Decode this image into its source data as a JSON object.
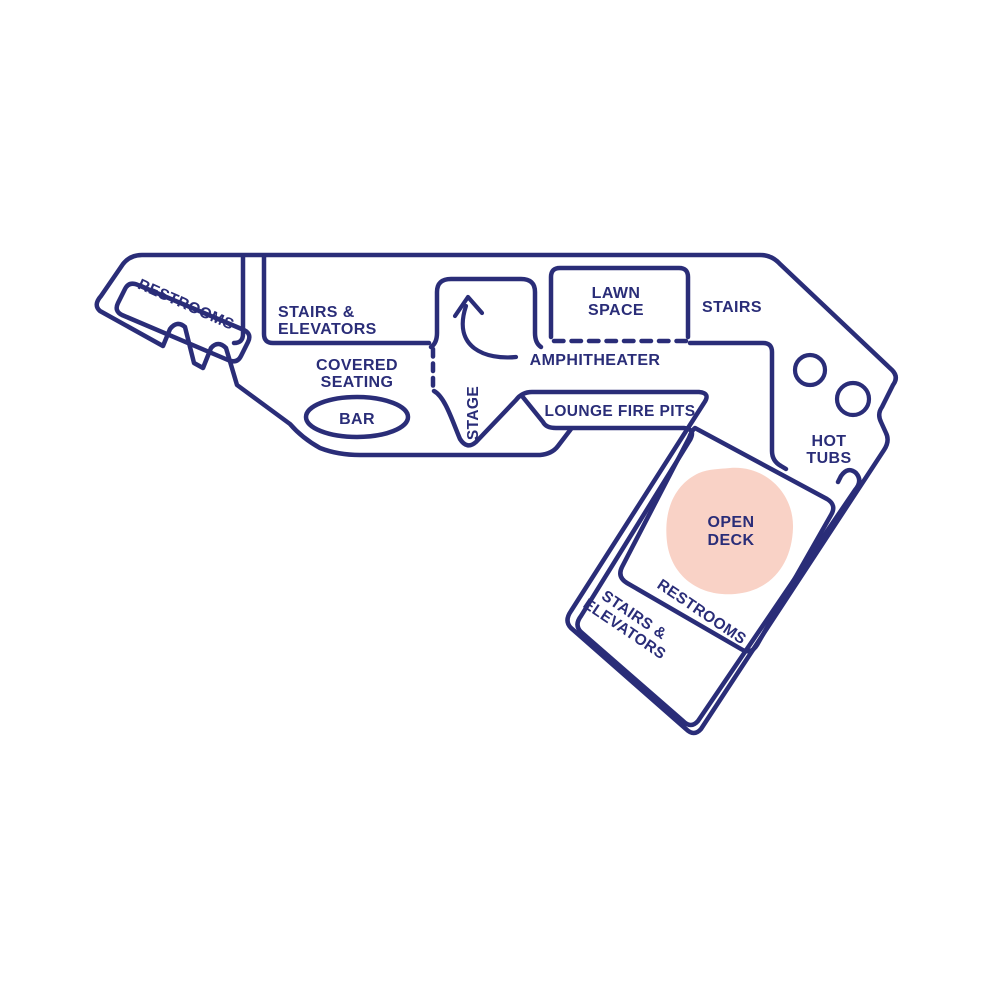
{
  "canvas": {
    "width": 1000,
    "height": 1000,
    "background": "#ffffff"
  },
  "colors": {
    "outline": "#2a2d78",
    "label_text": "#2a2d78",
    "open_deck_highlight": "#f9d2c6"
  },
  "icons": {
    "amphitheater_arrow": "curved-up-arrow",
    "hot_tub_1": "circle",
    "hot_tub_2": "circle"
  },
  "map": {
    "areas": {
      "restrooms_upper": {
        "label": "RESTROOMS"
      },
      "stairs_elevators_upper": {
        "line1": "STAIRS &",
        "line2": "ELEVATORS"
      },
      "covered_seating": {
        "line1": "COVERED",
        "line2": "SEATING"
      },
      "bar": {
        "label": "BAR"
      },
      "stage_area": {
        "label": "STAGE"
      },
      "amphitheater": {
        "label": "AMPHITHEATER"
      },
      "lawn_space": {
        "line1": "LAWN",
        "line2": "SPACE"
      },
      "stairs_upper_right": {
        "label": "STAIRS"
      },
      "lounge_fire_pits": {
        "label": "LOUNGE FIRE PITS"
      },
      "hot_tubs": {
        "line1": "HOT",
        "line2": "TUBS"
      },
      "open_deck": {
        "line1": "OPEN",
        "line2": "DECK",
        "highlighted": true,
        "highlight_color": "#f9d2c6"
      },
      "restrooms_lower": {
        "label": "RESTROOMS"
      },
      "stairs_elevators_lower": {
        "line1": "STAIRS &",
        "line2": "ELEVATORS"
      }
    }
  }
}
